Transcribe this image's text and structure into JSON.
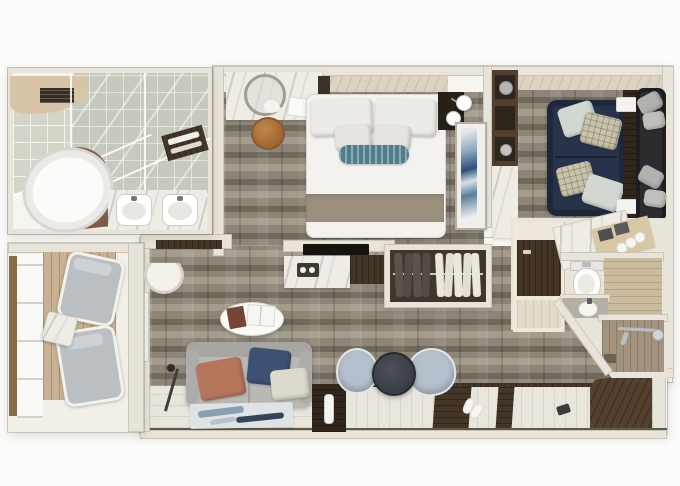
{
  "scene": {
    "kind": "3d-floor-plan-top-view",
    "subject": "Luxury suite stateroom floor plan rendering",
    "canvas": {
      "width": 680,
      "height": 486
    }
  },
  "palette": {
    "pageBg": "#fcfbf9",
    "floorBase": "#f7f5f0",
    "wall": "#e9e4d9",
    "wallEdge": "#b8b0a0",
    "carpet": "#8d8678",
    "carpetLight": "#a49d8e",
    "carpetDark": "#6f695c",
    "woodLight": "#dcd2c0",
    "deck": "#c9b294",
    "whitewash": "#e8e5dd",
    "walnut": "#433527",
    "walnutDeep": "#31261c",
    "darkFloor": "#54402f",
    "tile": "#c6c9bd",
    "marble": "#efece6",
    "woodWall": "#cbbc9f",
    "navySofa": "#27334a",
    "graySofa": "#b9b8b5",
    "terracotta": "#b5765c",
    "navyPillow": "#3d5173",
    "creamPillow": "#ddd9cd",
    "teal": "#4f7d89",
    "chairBlue": "#b3bfca",
    "tableDark": "#383c42",
    "stool": "#b0773e",
    "artBlue": "#2e4e78",
    "chrome": "#b9bec2",
    "towelShelf": "#d7c7a5",
    "deckPost": "#8a684a"
  },
  "rooms": [
    {
      "id": "master-bathroom",
      "label": "Master bathroom",
      "furniture": [
        "oval-bathtub",
        "double-vanity-sinks",
        "walk-in-shower-glass",
        "towel-shelf",
        "wood-ceiling-vent"
      ]
    },
    {
      "id": "vanity-area",
      "label": "Vanity / dressing area",
      "furniture": [
        "marble-vanity-desk",
        "round-mirror",
        "flowers",
        "notepad",
        "round-stool"
      ]
    },
    {
      "id": "bedroom",
      "label": "Bedroom",
      "furniture": [
        "king-bed",
        "white-pillows",
        "teal-bolster",
        "taupe-runner",
        "nightstand",
        "sphere-lamps",
        "blue-wall-art",
        "headboard-wood-panel"
      ]
    },
    {
      "id": "sitting-room",
      "label": "Sitting room",
      "furniture": [
        "navy-sofa",
        "sage-pillows",
        "patterned-pillows",
        "walnut-console",
        "white-trays",
        "dark-daybed",
        "gray-pillows",
        "shelving-unit",
        "minibar-marble"
      ]
    },
    {
      "id": "media-kitchenette",
      "label": "TV / minibar console",
      "furniture": [
        "tv",
        "marble-counter",
        "coffee-tray",
        "walnut-cabinet"
      ]
    },
    {
      "id": "walk-in-closet",
      "label": "Walk-in closet",
      "furniture": [
        "clothes-rail",
        "dark-garments",
        "light-garments"
      ]
    },
    {
      "id": "guest-bathroom",
      "label": "Second bathroom",
      "furniture": [
        "angled-marble-counter",
        "towel-shelf",
        "rolled-towels",
        "toilet",
        "sink",
        "wood-panel-wall",
        "wardrobe"
      ]
    },
    {
      "id": "shower-room",
      "label": "Shower room",
      "furniture": [
        "shower-pipe",
        "shower-head",
        "hand-shower",
        "drain"
      ]
    },
    {
      "id": "living-room",
      "label": "Living room",
      "furniture": [
        "gray-sofa",
        "terracotta-pillow",
        "navy-pillow",
        "cream-pillow",
        "oval-coffee-table",
        "books",
        "area-rug",
        "tv-console",
        "remote",
        "wall-desk",
        "desk-chair",
        "floor-lamp"
      ]
    },
    {
      "id": "dining-nook",
      "label": "Dining nook",
      "furniture": [
        "round-dark-table",
        "two-blue-tub-chairs"
      ]
    },
    {
      "id": "entry-hall",
      "label": "Entry hall",
      "furniture": [
        "whitewash-plank-floor",
        "dark-plank-inlays",
        "slippers",
        "door-mat-dark-floor"
      ]
    },
    {
      "id": "balcony",
      "label": "Balcony",
      "furniture": [
        "wood-deck",
        "two-loungers",
        "cube-side-table",
        "glass-railing",
        "rail-post"
      ]
    }
  ]
}
